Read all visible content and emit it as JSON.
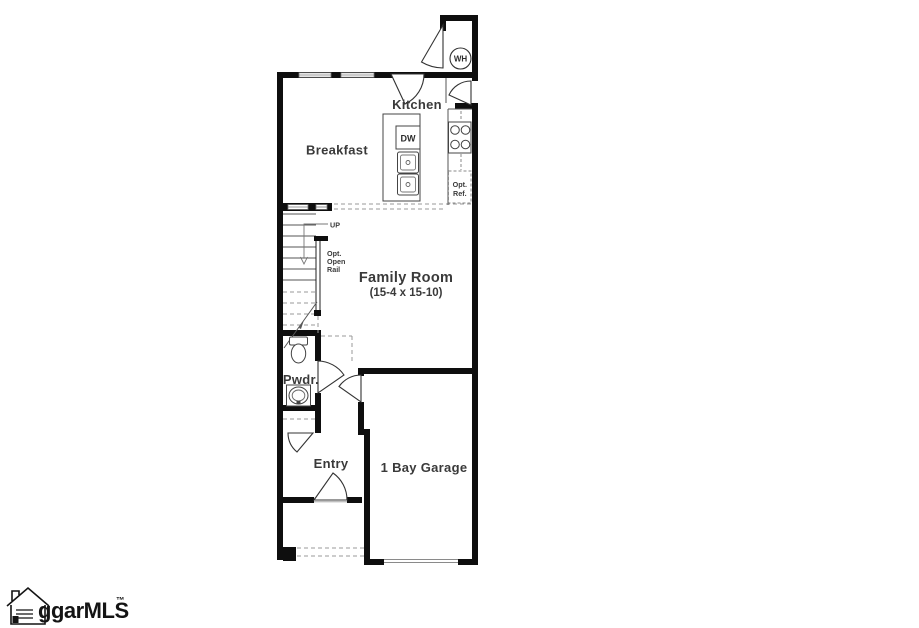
{
  "plan_title": "Townhome first floor plan",
  "rooms": {
    "kitchen": {
      "label": "Kitchen"
    },
    "breakfast": {
      "label": "Breakfast"
    },
    "family_room": {
      "label": "Family Room",
      "dimensions": "(15-4 x 15-10)"
    },
    "powder": {
      "label": "Pwdr."
    },
    "entry": {
      "label": "Entry"
    },
    "garage": {
      "label": "1 Bay Garage"
    }
  },
  "fixtures": {
    "water_heater": {
      "label": "WH"
    },
    "dishwasher": {
      "label": "DW"
    },
    "optional_refrigerator": {
      "line1": "Opt.",
      "line2": "Ref."
    },
    "stairs": {
      "direction": "UP",
      "rail_note_line1": "Opt.",
      "rail_note_line2": "Open",
      "rail_note_line3": "Rail"
    }
  },
  "watermark": {
    "brand": "ggarMLS",
    "tm": "™"
  },
  "colors": {
    "wall": "#0e0e0e",
    "label": "#3a3a3a",
    "dashed": "#999999",
    "background": "#ffffff"
  }
}
